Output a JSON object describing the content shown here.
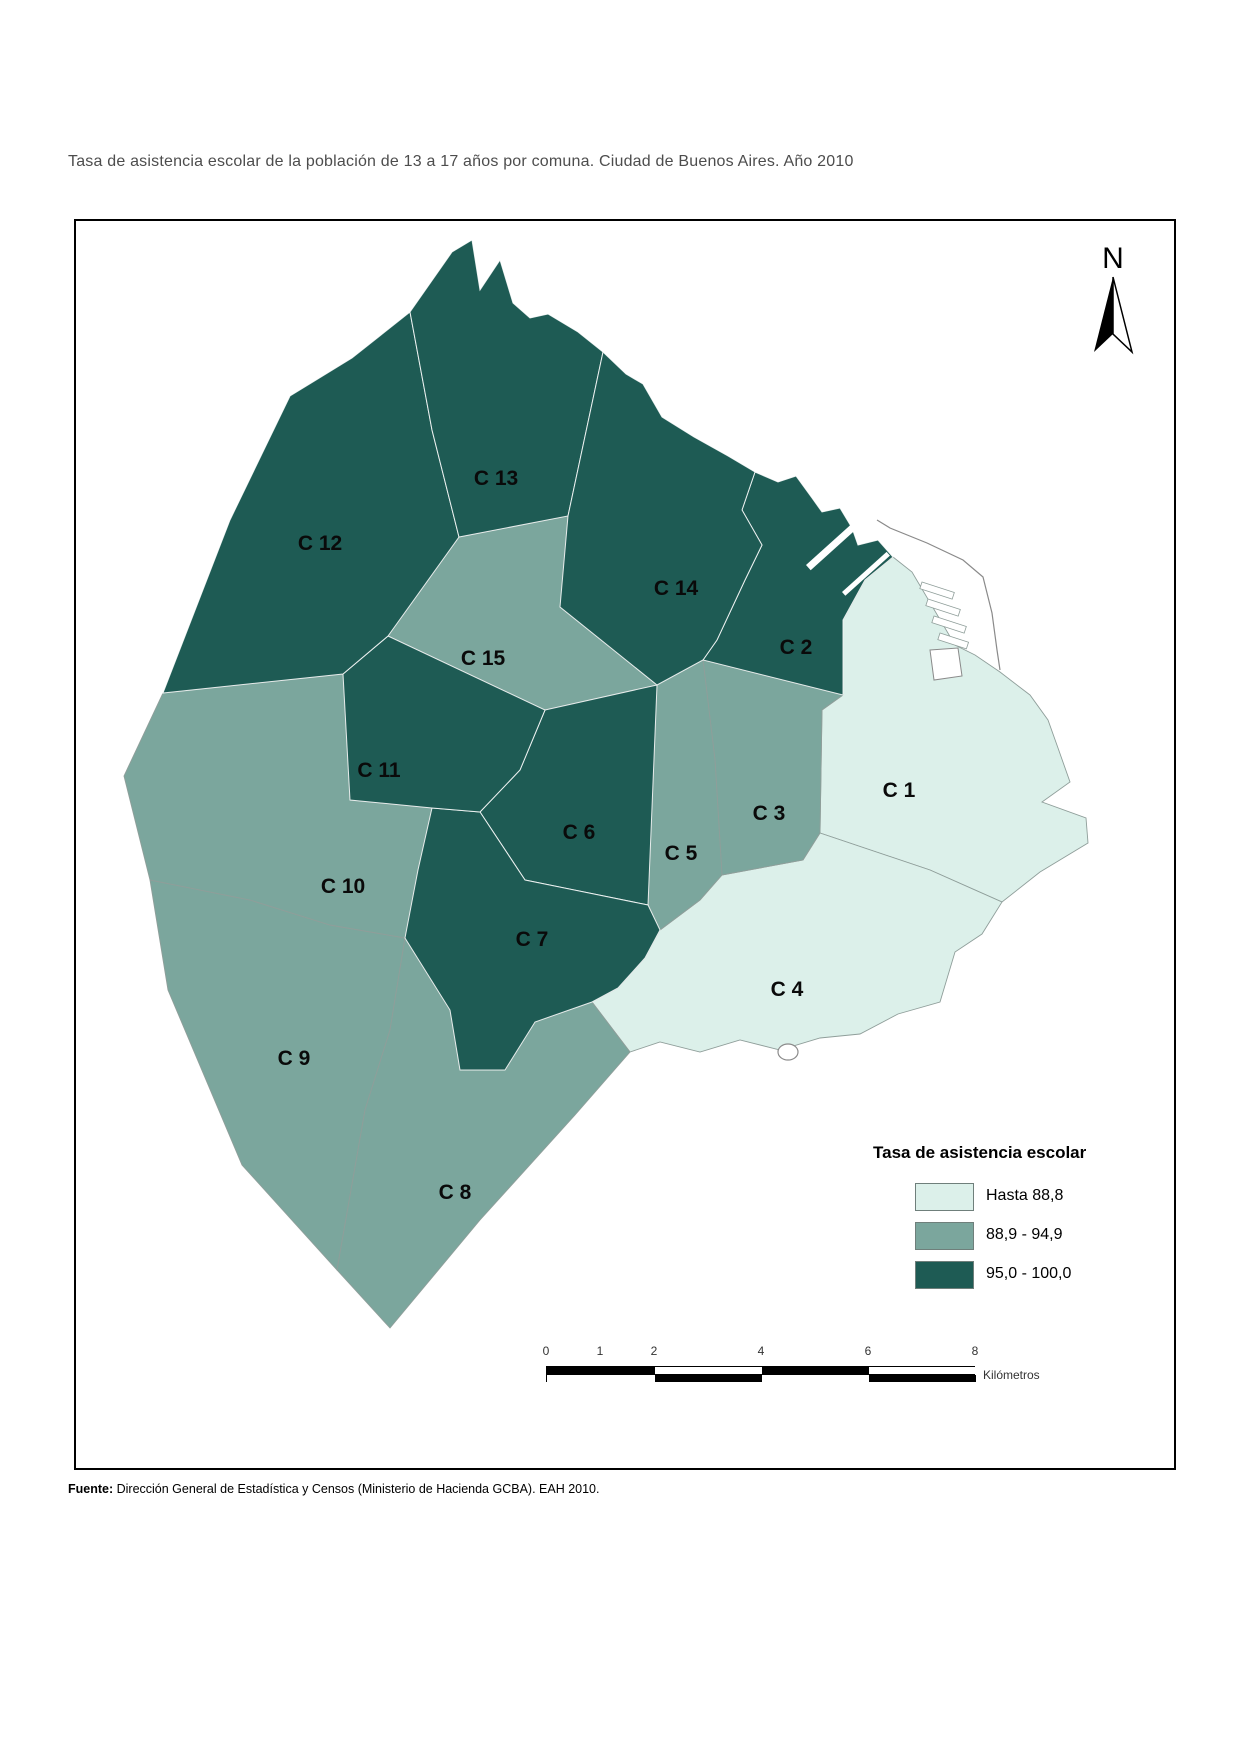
{
  "title": "Tasa de asistencia escolar de la población de 13 a 17 años por comuna. Ciudad de Buenos Aires. Año 2010",
  "map": {
    "north_label": "N",
    "comunas": [
      {
        "id": "c1",
        "label": "C 1",
        "class": "light",
        "label_x": 899,
        "label_y": 790
      },
      {
        "id": "c2",
        "label": "C 2",
        "class": "dark",
        "label_x": 796,
        "label_y": 647
      },
      {
        "id": "c3",
        "label": "C 3",
        "class": "medium",
        "label_x": 769,
        "label_y": 813
      },
      {
        "id": "c4",
        "label": "C 4",
        "class": "light",
        "label_x": 787,
        "label_y": 989
      },
      {
        "id": "c5",
        "label": "C 5",
        "class": "medium",
        "label_x": 681,
        "label_y": 853
      },
      {
        "id": "c6",
        "label": "C 6",
        "class": "dark",
        "label_x": 579,
        "label_y": 832
      },
      {
        "id": "c7",
        "label": "C 7",
        "class": "dark",
        "label_x": 532,
        "label_y": 939
      },
      {
        "id": "c8",
        "label": "C 8",
        "class": "medium",
        "label_x": 455,
        "label_y": 1192
      },
      {
        "id": "c9",
        "label": "C 9",
        "class": "medium",
        "label_x": 294,
        "label_y": 1058
      },
      {
        "id": "c10",
        "label": "C 10",
        "class": "medium",
        "label_x": 343,
        "label_y": 886
      },
      {
        "id": "c11",
        "label": "C 11",
        "class": "dark",
        "label_x": 379,
        "label_y": 770
      },
      {
        "id": "c12",
        "label": "C 12",
        "class": "dark",
        "label_x": 320,
        "label_y": 543
      },
      {
        "id": "c13",
        "label": "C 13",
        "class": "dark",
        "label_x": 496,
        "label_y": 478
      },
      {
        "id": "c14",
        "label": "C 14",
        "class": "dark",
        "label_x": 676,
        "label_y": 588
      },
      {
        "id": "c15",
        "label": "C 15",
        "class": "medium",
        "label_x": 483,
        "label_y": 658
      }
    ]
  },
  "legend": {
    "title": "Tasa de asistencia escolar",
    "items": [
      {
        "label": "Hasta 88,8",
        "color": "#dcf0ea",
        "class": "light"
      },
      {
        "label": "88,9 - 94,9",
        "color": "#7ba69d",
        "class": "medium"
      },
      {
        "label": "95,0 - 100,0",
        "color": "#1e5b54",
        "class": "dark"
      }
    ]
  },
  "scalebar": {
    "ticks": [
      "0",
      "1",
      "2",
      "4",
      "6",
      "8"
    ],
    "unit": "Kilómetros"
  },
  "source": {
    "prefix": "Fuente:",
    "text": " Dirección General de Estadística y Censos (Ministerio de Hacienda GCBA). EAH 2010."
  },
  "colors": {
    "boundary_on_dark": "#ffffff",
    "boundary_on_light": "#8f9e9a",
    "coast_outline": "#8a8a8a",
    "frame": "#000000",
    "title_text": "#4d4d4d"
  }
}
